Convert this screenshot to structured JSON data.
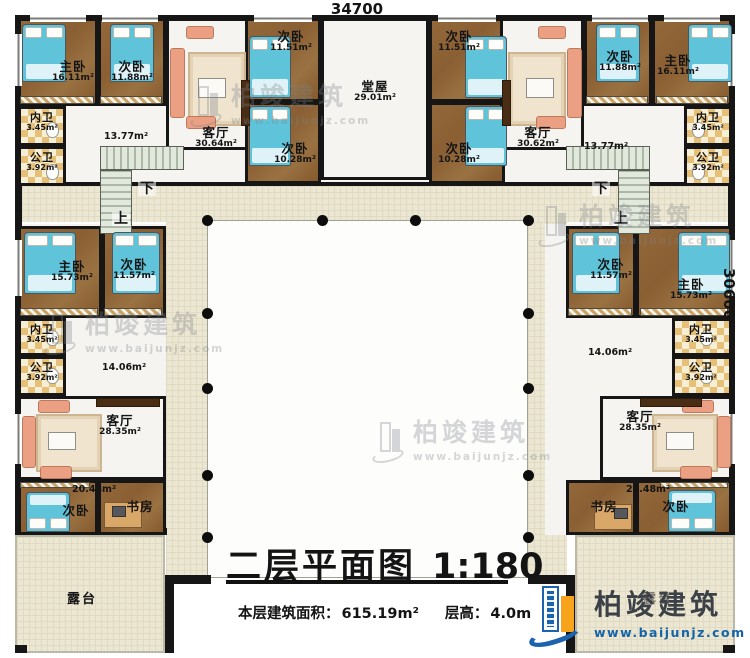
{
  "plan": {
    "title": "二层平面图",
    "scale": "1:180",
    "area_label": "本层建筑面积：",
    "area_value": "615.19m²",
    "height_label": "层高：",
    "height_value": "4.0m",
    "dim_width": "34700",
    "dim_height": "30600",
    "up": "上",
    "down": "下"
  },
  "brand": {
    "name": "柏竣建筑",
    "url": "www.baijunjz.com"
  },
  "rooms": {
    "master_tl": {
      "label": "主卧",
      "area": "16.11m²"
    },
    "bed2_tl": {
      "label": "次卧",
      "area": "11.88m²"
    },
    "living_tl": {
      "label": "客厅",
      "area": "30.64m²"
    },
    "bed_t3": {
      "label": "次卧",
      "area": "11.51m²"
    },
    "bed_t4": {
      "label": "次卧",
      "area": "10.28m²"
    },
    "tangwu": {
      "label": "堂屋",
      "area": "29.01m²"
    },
    "bed_t5": {
      "label": "次卧",
      "area": "11.51m²"
    },
    "bed_t6": {
      "label": "次卧",
      "area": "10.28m²"
    },
    "living_tr": {
      "label": "客厅",
      "area": "30.62m²"
    },
    "bed2_tr": {
      "label": "次卧",
      "area": "11.88m²"
    },
    "master_tr": {
      "label": "主卧",
      "area": "16.11m²"
    },
    "bath_inner_tl": {
      "label": "内卫",
      "area": "3.45m²"
    },
    "bath_pub_tl": {
      "label": "公卫",
      "area": "3.92m²"
    },
    "bath_inner_tr": {
      "label": "内卫",
      "area": "3.45m²"
    },
    "bath_pub_tr": {
      "label": "公卫",
      "area": "3.92m²"
    },
    "hall_tl": {
      "area": "13.77m²"
    },
    "hall_tr": {
      "area": "13.77m²"
    },
    "master_ml": {
      "label": "主卧",
      "area": "15.73m²"
    },
    "bed_ml": {
      "label": "次卧",
      "area": "11.57m²"
    },
    "bath_inner_ml": {
      "label": "内卫",
      "area": "3.45m²"
    },
    "bath_pub_ml": {
      "label": "公卫",
      "area": "3.92m²"
    },
    "hall_ml": {
      "area": "14.06m²"
    },
    "living_ml": {
      "label": "客厅",
      "area": "28.35m²"
    },
    "suite_bl": {
      "area": "20.48m²"
    },
    "bed_bl": {
      "label": "次卧"
    },
    "study_bl": {
      "label": "书房"
    },
    "terrace_l": {
      "label": "露台"
    },
    "bed_mr": {
      "label": "次卧",
      "area": "11.57m²"
    },
    "master_mr": {
      "label": "主卧",
      "area": "15.73m²"
    },
    "bath_inner_mr": {
      "label": "内卫",
      "area": "3.45m²"
    },
    "bath_pub_mr": {
      "label": "公卫",
      "area": "3.92m²"
    },
    "hall_mr": {
      "area": "14.06m²"
    },
    "living_mr": {
      "label": "客厅",
      "area": "28.35m²"
    },
    "suite_br": {
      "area": "20.48m²"
    },
    "study_br": {
      "label": "书房"
    },
    "bed_br": {
      "label": "次卧"
    },
    "terrace_r": {
      "label": "露台"
    }
  }
}
